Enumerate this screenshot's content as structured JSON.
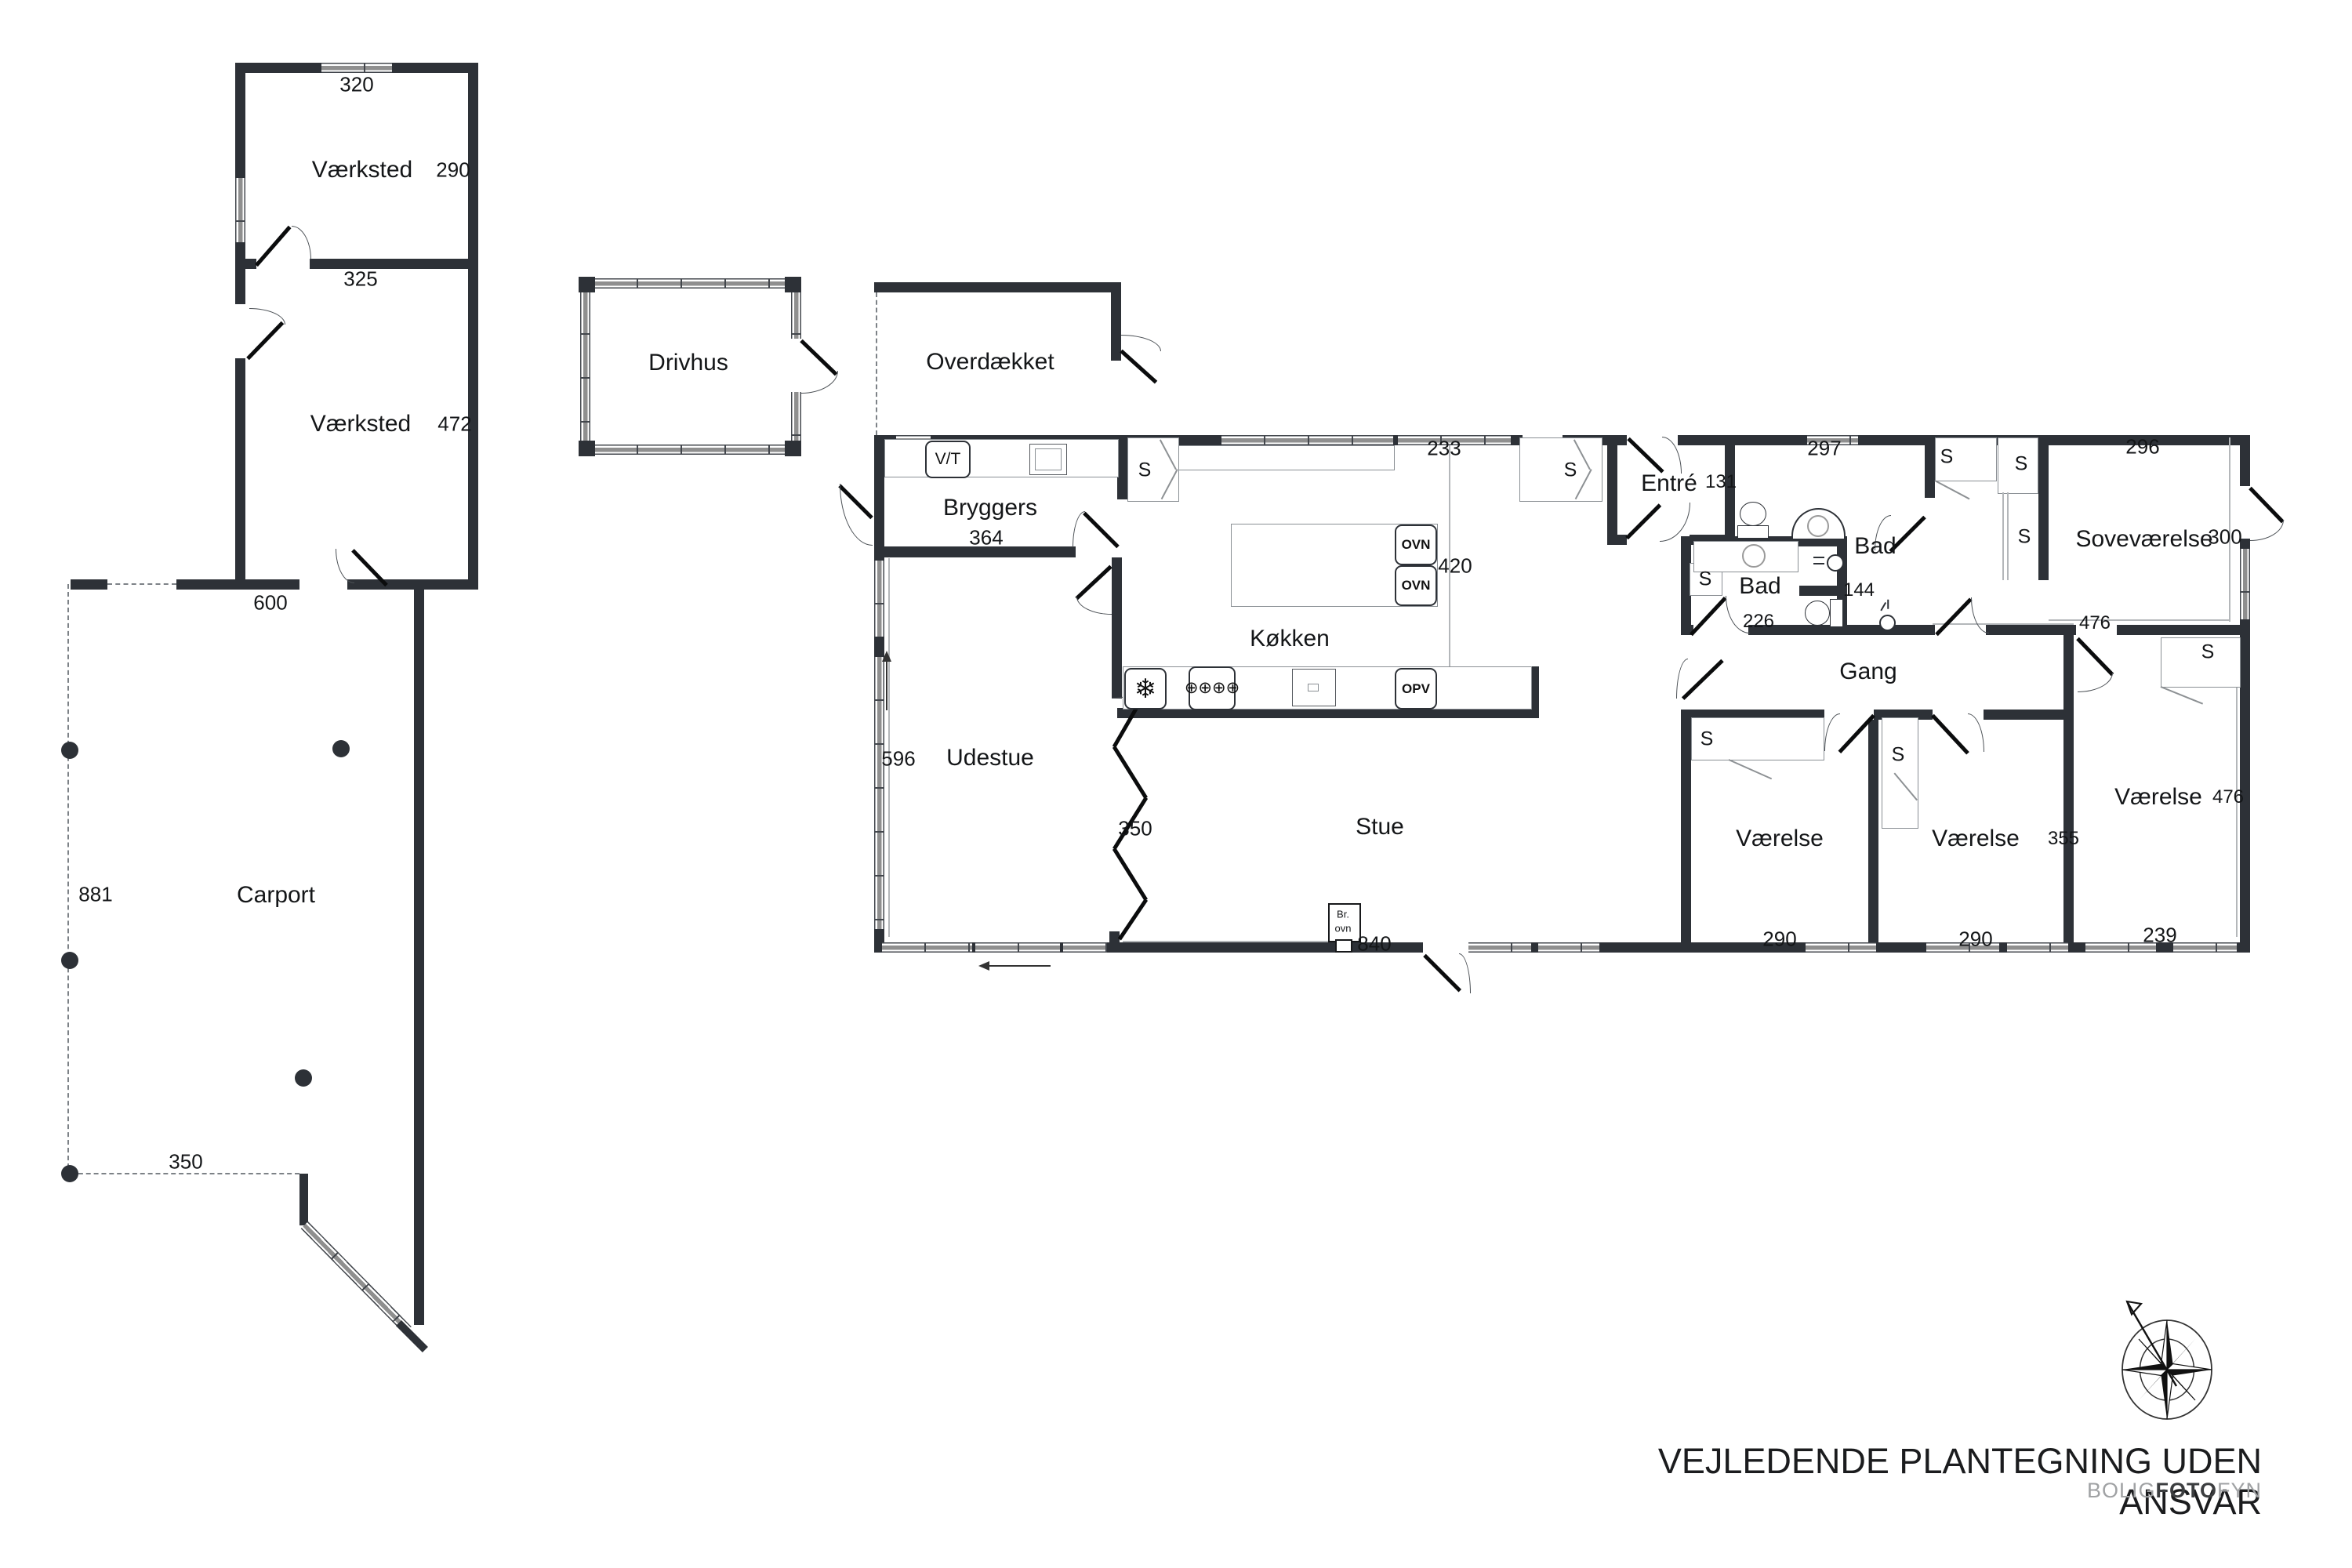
{
  "closet": {
    "label": "S"
  },
  "outbuilding": {
    "vaerksted1": {
      "name": "Værksted",
      "width_top": "320",
      "height_right": "290",
      "width_bottom": "325"
    },
    "vaerksted2": {
      "name": "Værksted",
      "height_right": "472",
      "width_bottom": "600"
    },
    "carport": {
      "name": "Carport",
      "height_left": "881",
      "width_bottom": "350"
    }
  },
  "annex": {
    "drivhus": {
      "name": "Drivhus"
    },
    "overdaekket": {
      "name": "Overdækket"
    }
  },
  "house": {
    "bryggers": {
      "name": "Bryggers",
      "width": "364",
      "washer": "V/T"
    },
    "koekken": {
      "name": "Køkken",
      "window_width": "233",
      "depth": "420",
      "oven": "OVN",
      "dishwasher": "OPV"
    },
    "udestue": {
      "name": "Udestue",
      "height": "596",
      "fold_wall": "350"
    },
    "stue": {
      "name": "Stue",
      "width": "840",
      "stove_line1": "Br.",
      "stove_line2": "ovn"
    },
    "entre": {
      "name": "Entré",
      "width": "131"
    },
    "bad_large": {
      "name": "Bad",
      "window_width": "297",
      "inner_wall": "144"
    },
    "bad_small": {
      "name": "Bad",
      "width": "226"
    },
    "gang": {
      "name": "Gang",
      "length": "476"
    },
    "sovevaerelse": {
      "name": "Soveværelse",
      "width": "296",
      "depth": "300"
    },
    "vaerelse1": {
      "name": "Værelse",
      "width": "290"
    },
    "vaerelse2": {
      "name": "Værelse",
      "width": "290",
      "depth": "355"
    },
    "vaerelse3": {
      "name": "Værelse",
      "depth": "476",
      "width": "239"
    }
  },
  "footer": {
    "title": "VEJLEDENDE PLANTEGNING UDEN ANSVAR",
    "brand_bolig": "BOLIG",
    "brand_foto": "FOTO",
    "brand_fyn": "FYN"
  }
}
